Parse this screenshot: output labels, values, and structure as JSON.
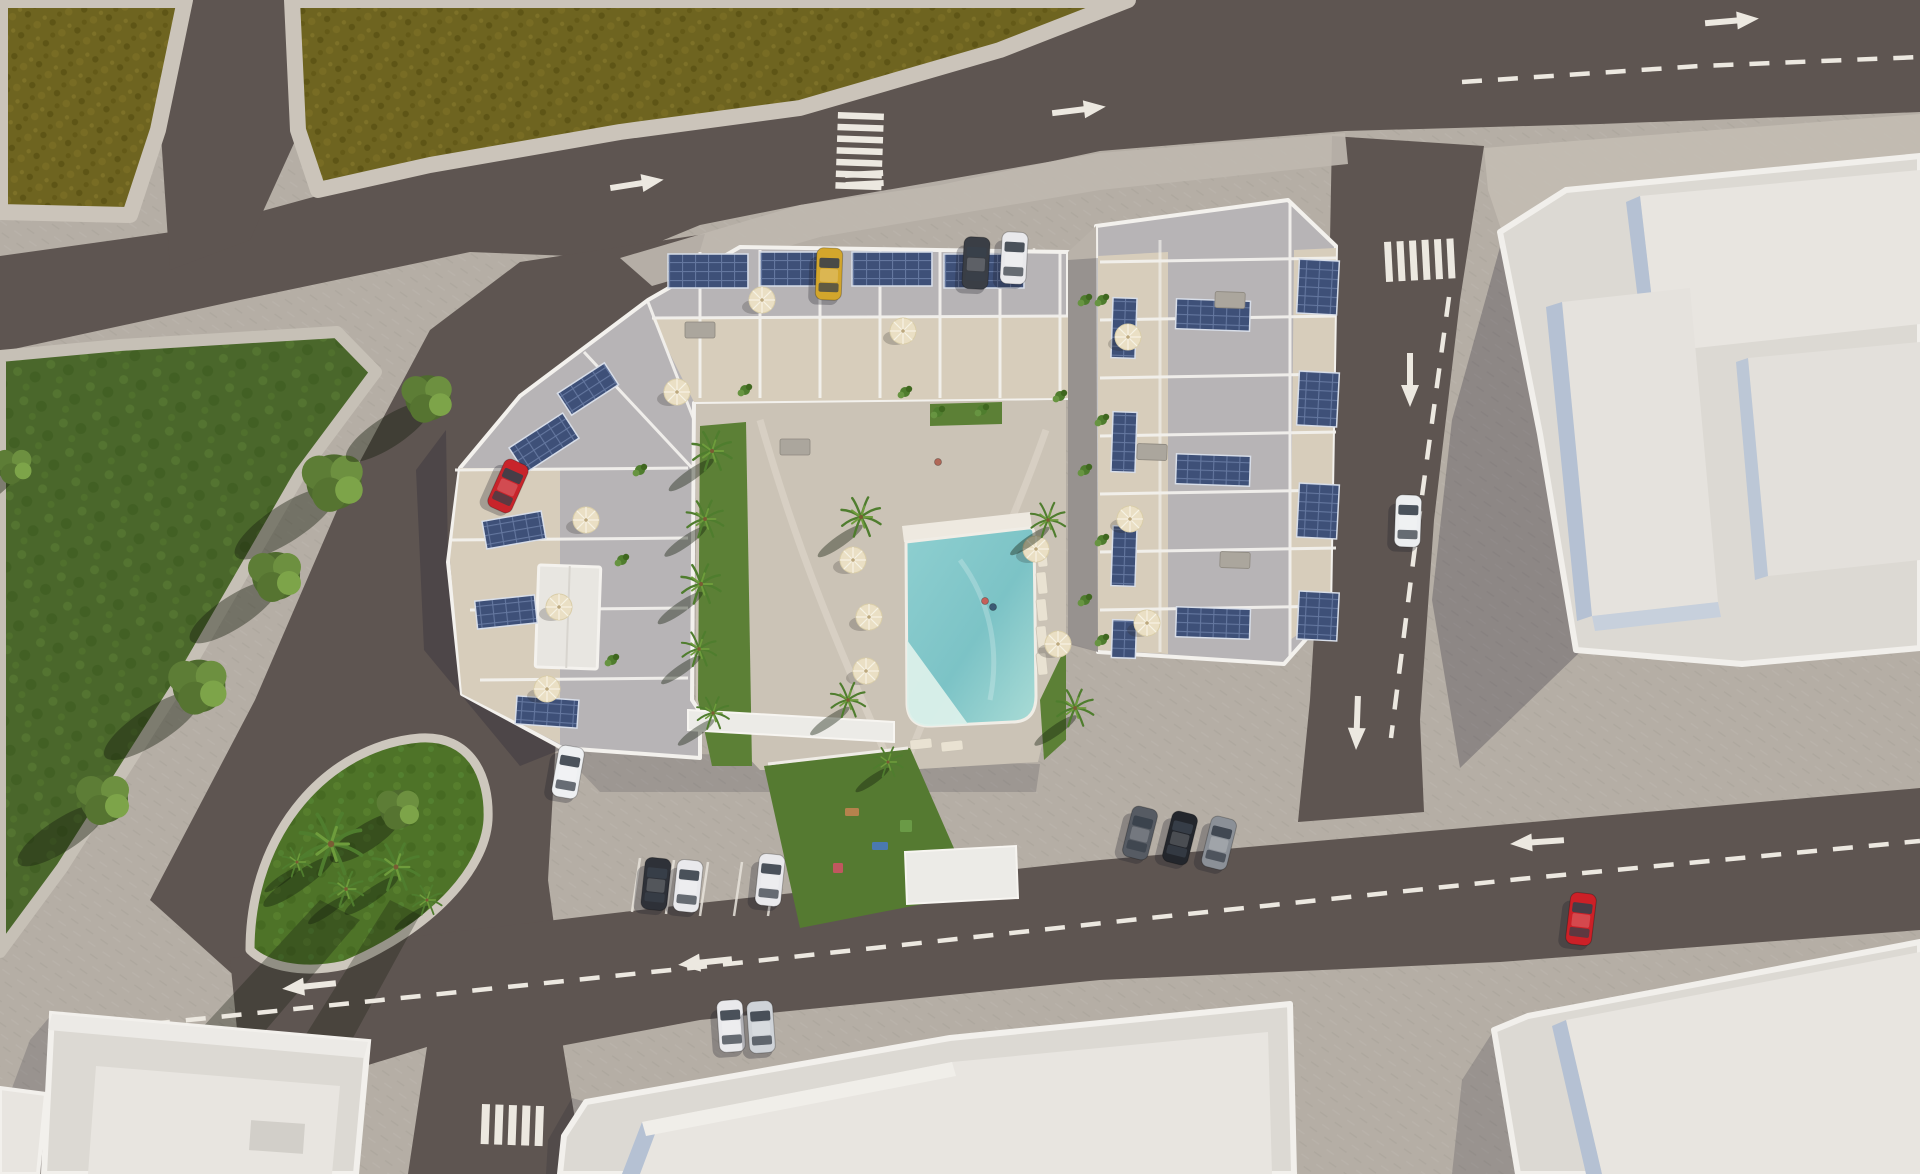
{
  "scene": {
    "description": "aerial-3d-render-apartment-complex",
    "colors": {
      "pavement": "#b5aea5",
      "pavement_light": "#c0b9b0",
      "road": "#5e5551",
      "road_shade": "#554d49",
      "field": "#6e6420",
      "park": "#4a672b",
      "island": "#4e7328",
      "lawn": "#5c8036",
      "roof": "#b7b4b6",
      "terrace": "#d7cdbb",
      "courtyard": "#cbc3b6",
      "wall_white": "#f3f1ed",
      "building": "#dcd9d3",
      "building_light": "#e8e5e0",
      "building_face": "#b5c1d3",
      "building_face2": "#c7d0dc",
      "pool_deep": "#85c8ca",
      "pool_light": "#bfe6e0",
      "pool_pale": "#dbf0ea",
      "solar": "#3e5078",
      "solar_line": "#64779f",
      "umbrella": "#eadfc4",
      "marking": "#ece8e0",
      "shadow": "rgba(32,30,48,0.27)",
      "tree_shadow": "rgba(24,32,14,0.42)"
    },
    "markings": {
      "arrows": [
        {
          "x": 636,
          "y": 184,
          "r": -9
        },
        {
          "x": 1078,
          "y": 110,
          "r": -7
        },
        {
          "x": 1731,
          "y": 21,
          "r": -5
        },
        {
          "x": 479,
          "y": 584,
          "r": -58
        },
        {
          "x": 1410,
          "y": 379,
          "r": 90
        },
        {
          "x": 1357,
          "y": 722,
          "r": 92
        },
        {
          "x": 706,
          "y": 962,
          "r": 174
        },
        {
          "x": 1538,
          "y": 842,
          "r": 176
        },
        {
          "x": 310,
          "y": 986,
          "r": 174
        }
      ],
      "crosswalks": [
        {
          "x": 838,
          "y": 112,
          "r": 2,
          "n": 7,
          "w": 46,
          "h": 6.5,
          "gap": 5.2,
          "axis": "h"
        },
        {
          "x": 845,
          "y": 172,
          "r": -3,
          "n": 2,
          "w": 38,
          "h": 6,
          "gap": 4,
          "axis": "h"
        },
        {
          "x": 1384,
          "y": 242,
          "r": -3,
          "n": 6,
          "w": 7,
          "h": 40,
          "gap": 5.5,
          "axis": "v"
        },
        {
          "x": 482,
          "y": 1104,
          "r": 2,
          "n": 5,
          "w": 8,
          "h": 40,
          "gap": 5.5,
          "axis": "v"
        }
      ],
      "dashes": [
        {
          "pts": [
            [
              1462,
              82
            ],
            [
              1700,
              66
            ],
            [
              1920,
              57
            ]
          ]
        },
        {
          "pts": [
            [
              1449,
              297
            ],
            [
              1414,
              555
            ],
            [
              1391,
              738
            ]
          ]
        },
        {
          "pts": [
            [
              150,
              1024
            ],
            [
              700,
              967
            ],
            [
              1140,
              919
            ],
            [
              1520,
              879
            ],
            [
              1920,
              841
            ]
          ]
        }
      ],
      "stall_lines": [
        [
          640,
          858,
          632,
          912
        ],
        [
          674,
          860,
          666,
          914
        ],
        [
          708,
          862,
          700,
          916
        ],
        [
          742,
          862,
          734,
          916
        ],
        [
          776,
          862,
          768,
          916
        ],
        [
          950,
          250,
          950,
          286
        ],
        [
          992,
          249,
          992,
          285
        ],
        [
          1034,
          248,
          1034,
          284
        ]
      ]
    },
    "cars": [
      {
        "x": 829,
        "y": 274,
        "r": 2,
        "color": "#d3a62c",
        "name": "yellow-car"
      },
      {
        "x": 976,
        "y": 263,
        "r": 3,
        "color": "#3a3e45",
        "name": "dark-car"
      },
      {
        "x": 1014,
        "y": 258,
        "r": 3,
        "color": "#e9e9ec",
        "name": "white-car"
      },
      {
        "x": 508,
        "y": 486,
        "r": 24,
        "color": "#c8242b",
        "name": "red-car-west"
      },
      {
        "x": 568,
        "y": 772,
        "r": 10,
        "color": "#eef0f2",
        "name": "white-van"
      },
      {
        "x": 656,
        "y": 884,
        "r": 6,
        "color": "#2e3138",
        "name": "dark-car-south"
      },
      {
        "x": 688,
        "y": 886,
        "r": 6,
        "color": "#e9e9ec",
        "name": "white-car-south"
      },
      {
        "x": 770,
        "y": 880,
        "r": 6,
        "color": "#e9e9ec",
        "name": "white-car-south2"
      },
      {
        "x": 731,
        "y": 1026,
        "r": -4,
        "color": "#e9e9ec",
        "name": "white-car-road"
      },
      {
        "x": 761,
        "y": 1027,
        "r": -4,
        "color": "#cfd3d8",
        "name": "silver-car-road"
      },
      {
        "x": 1140,
        "y": 833,
        "r": 14,
        "color": "#565b63",
        "name": "gray-car-east"
      },
      {
        "x": 1180,
        "y": 838,
        "r": 14,
        "color": "#23262c",
        "name": "black-car-east"
      },
      {
        "x": 1219,
        "y": 843,
        "r": 14,
        "color": "#8b9097",
        "name": "gray-car-east2"
      },
      {
        "x": 1408,
        "y": 521,
        "r": 2,
        "color": "#eceef0",
        "name": "white-car-right-road"
      },
      {
        "x": 1581,
        "y": 919,
        "r": 7,
        "color": "#cc2027",
        "name": "red-car-bottom"
      }
    ],
    "trees": [
      {
        "x": 334,
        "y": 482,
        "s": 1.15
      },
      {
        "x": 276,
        "y": 576,
        "s": 1.0
      },
      {
        "x": 199,
        "y": 686,
        "s": 1.1
      },
      {
        "x": 428,
        "y": 398,
        "s": 0.95
      },
      {
        "x": 104,
        "y": 799,
        "s": 1.0
      },
      {
        "x": 14,
        "y": 466,
        "s": 0.7
      },
      {
        "x": 399,
        "y": 809,
        "s": 0.8
      }
    ],
    "palms": [
      {
        "x": 331,
        "y": 844,
        "s": 1.25
      },
      {
        "x": 396,
        "y": 867,
        "s": 0.95
      },
      {
        "x": 346,
        "y": 889,
        "s": 0.7
      },
      {
        "x": 427,
        "y": 900,
        "s": 0.6
      },
      {
        "x": 297,
        "y": 862,
        "s": 0.6
      },
      {
        "x": 712,
        "y": 451,
        "s": 0.8
      },
      {
        "x": 705,
        "y": 519,
        "s": 0.75
      },
      {
        "x": 701,
        "y": 584,
        "s": 0.8
      },
      {
        "x": 699,
        "y": 649,
        "s": 0.7
      },
      {
        "x": 713,
        "y": 713,
        "s": 0.65
      },
      {
        "x": 861,
        "y": 517,
        "s": 0.8
      },
      {
        "x": 848,
        "y": 700,
        "s": 0.7
      },
      {
        "x": 1048,
        "y": 520,
        "s": 0.7
      },
      {
        "x": 1075,
        "y": 708,
        "s": 0.75
      },
      {
        "x": 888,
        "y": 762,
        "s": 0.6
      }
    ],
    "umbrellas": [
      {
        "x": 677,
        "y": 392
      },
      {
        "x": 762,
        "y": 300
      },
      {
        "x": 903,
        "y": 331
      },
      {
        "x": 586,
        "y": 520
      },
      {
        "x": 559,
        "y": 607
      },
      {
        "x": 547,
        "y": 689
      },
      {
        "x": 1128,
        "y": 337
      },
      {
        "x": 1130,
        "y": 519
      },
      {
        "x": 1147,
        "y": 623
      },
      {
        "x": 853,
        "y": 560
      },
      {
        "x": 869,
        "y": 617
      },
      {
        "x": 866,
        "y": 671
      },
      {
        "x": 1036,
        "y": 549
      },
      {
        "x": 1058,
        "y": 644
      }
    ],
    "solar_arrays": [
      {
        "x": 668,
        "y": 254,
        "w": 80,
        "h": 34,
        "r": 0
      },
      {
        "x": 760,
        "y": 252,
        "w": 80,
        "h": 34,
        "r": 0
      },
      {
        "x": 852,
        "y": 252,
        "w": 80,
        "h": 34,
        "r": 0
      },
      {
        "x": 944,
        "y": 254,
        "w": 80,
        "h": 34,
        "r": 0
      },
      {
        "x": 512,
        "y": 428,
        "w": 64,
        "h": 30,
        "r": -33
      },
      {
        "x": 484,
        "y": 516,
        "w": 60,
        "h": 28,
        "r": -10
      },
      {
        "x": 476,
        "y": 598,
        "w": 60,
        "h": 28,
        "r": -6
      },
      {
        "x": 516,
        "y": 698,
        "w": 62,
        "h": 28,
        "r": 4
      },
      {
        "x": 560,
        "y": 376,
        "w": 56,
        "h": 26,
        "r": -33
      },
      {
        "x": 1298,
        "y": 260,
        "w": 40,
        "h": 54,
        "r": 3
      },
      {
        "x": 1298,
        "y": 372,
        "w": 40,
        "h": 54,
        "r": 3
      },
      {
        "x": 1298,
        "y": 484,
        "w": 40,
        "h": 54,
        "r": 3
      },
      {
        "x": 1298,
        "y": 592,
        "w": 40,
        "h": 48,
        "r": 3
      },
      {
        "x": 1112,
        "y": 298,
        "w": 24,
        "h": 60,
        "r": 2
      },
      {
        "x": 1112,
        "y": 412,
        "w": 24,
        "h": 60,
        "r": 2
      },
      {
        "x": 1112,
        "y": 526,
        "w": 24,
        "h": 60,
        "r": 2
      },
      {
        "x": 1112,
        "y": 620,
        "w": 24,
        "h": 38,
        "r": 2
      },
      {
        "x": 1176,
        "y": 300,
        "w": 74,
        "h": 30,
        "r": 2
      },
      {
        "x": 1176,
        "y": 455,
        "w": 74,
        "h": 30,
        "r": 2
      },
      {
        "x": 1176,
        "y": 608,
        "w": 74,
        "h": 30,
        "r": 2
      }
    ],
    "loungers": [
      {
        "x": 1042,
        "y": 556,
        "r": -6
      },
      {
        "x": 1042,
        "y": 583,
        "r": -6
      },
      {
        "x": 1042,
        "y": 610,
        "r": -6
      },
      {
        "x": 1042,
        "y": 637,
        "r": -6
      },
      {
        "x": 1042,
        "y": 664,
        "r": -6
      },
      {
        "x": 921,
        "y": 744,
        "r": 84
      },
      {
        "x": 952,
        "y": 746,
        "r": 84
      }
    ],
    "tables": [
      {
        "x": 795,
        "y": 447,
        "r": 0
      },
      {
        "x": 700,
        "y": 330,
        "r": 0
      },
      {
        "x": 1230,
        "y": 300,
        "r": 2
      },
      {
        "x": 1235,
        "y": 560,
        "r": 2
      },
      {
        "x": 1152,
        "y": 452,
        "r": 2
      }
    ],
    "plants": [
      {
        "x": 1085,
        "y": 300
      },
      {
        "x": 1085,
        "y": 470
      },
      {
        "x": 1085,
        "y": 600
      },
      {
        "x": 745,
        "y": 390
      },
      {
        "x": 905,
        "y": 392
      },
      {
        "x": 1060,
        "y": 396
      },
      {
        "x": 640,
        "y": 470
      },
      {
        "x": 622,
        "y": 560
      },
      {
        "x": 612,
        "y": 660
      },
      {
        "x": 1102,
        "y": 300
      },
      {
        "x": 1102,
        "y": 420
      },
      {
        "x": 1102,
        "y": 540
      },
      {
        "x": 1102,
        "y": 640
      },
      {
        "x": 938,
        "y": 412
      },
      {
        "x": 982,
        "y": 410
      }
    ],
    "playground_items": [
      {
        "x": 852,
        "y": 812,
        "w": 14,
        "h": 8,
        "color": "#b5824d"
      },
      {
        "x": 880,
        "y": 846,
        "w": 16,
        "h": 8,
        "color": "#4a79b0"
      },
      {
        "x": 906,
        "y": 826,
        "w": 12,
        "h": 12,
        "color": "#6a9a46"
      },
      {
        "x": 838,
        "y": 868,
        "w": 10,
        "h": 10,
        "color": "#c0575f"
      }
    ],
    "people": [
      {
        "x": 985,
        "y": 601,
        "color": "#c4605a"
      },
      {
        "x": 993,
        "y": 607,
        "color": "#3c5a74"
      },
      {
        "x": 938,
        "y": 462,
        "color": "#b06858"
      }
    ]
  }
}
